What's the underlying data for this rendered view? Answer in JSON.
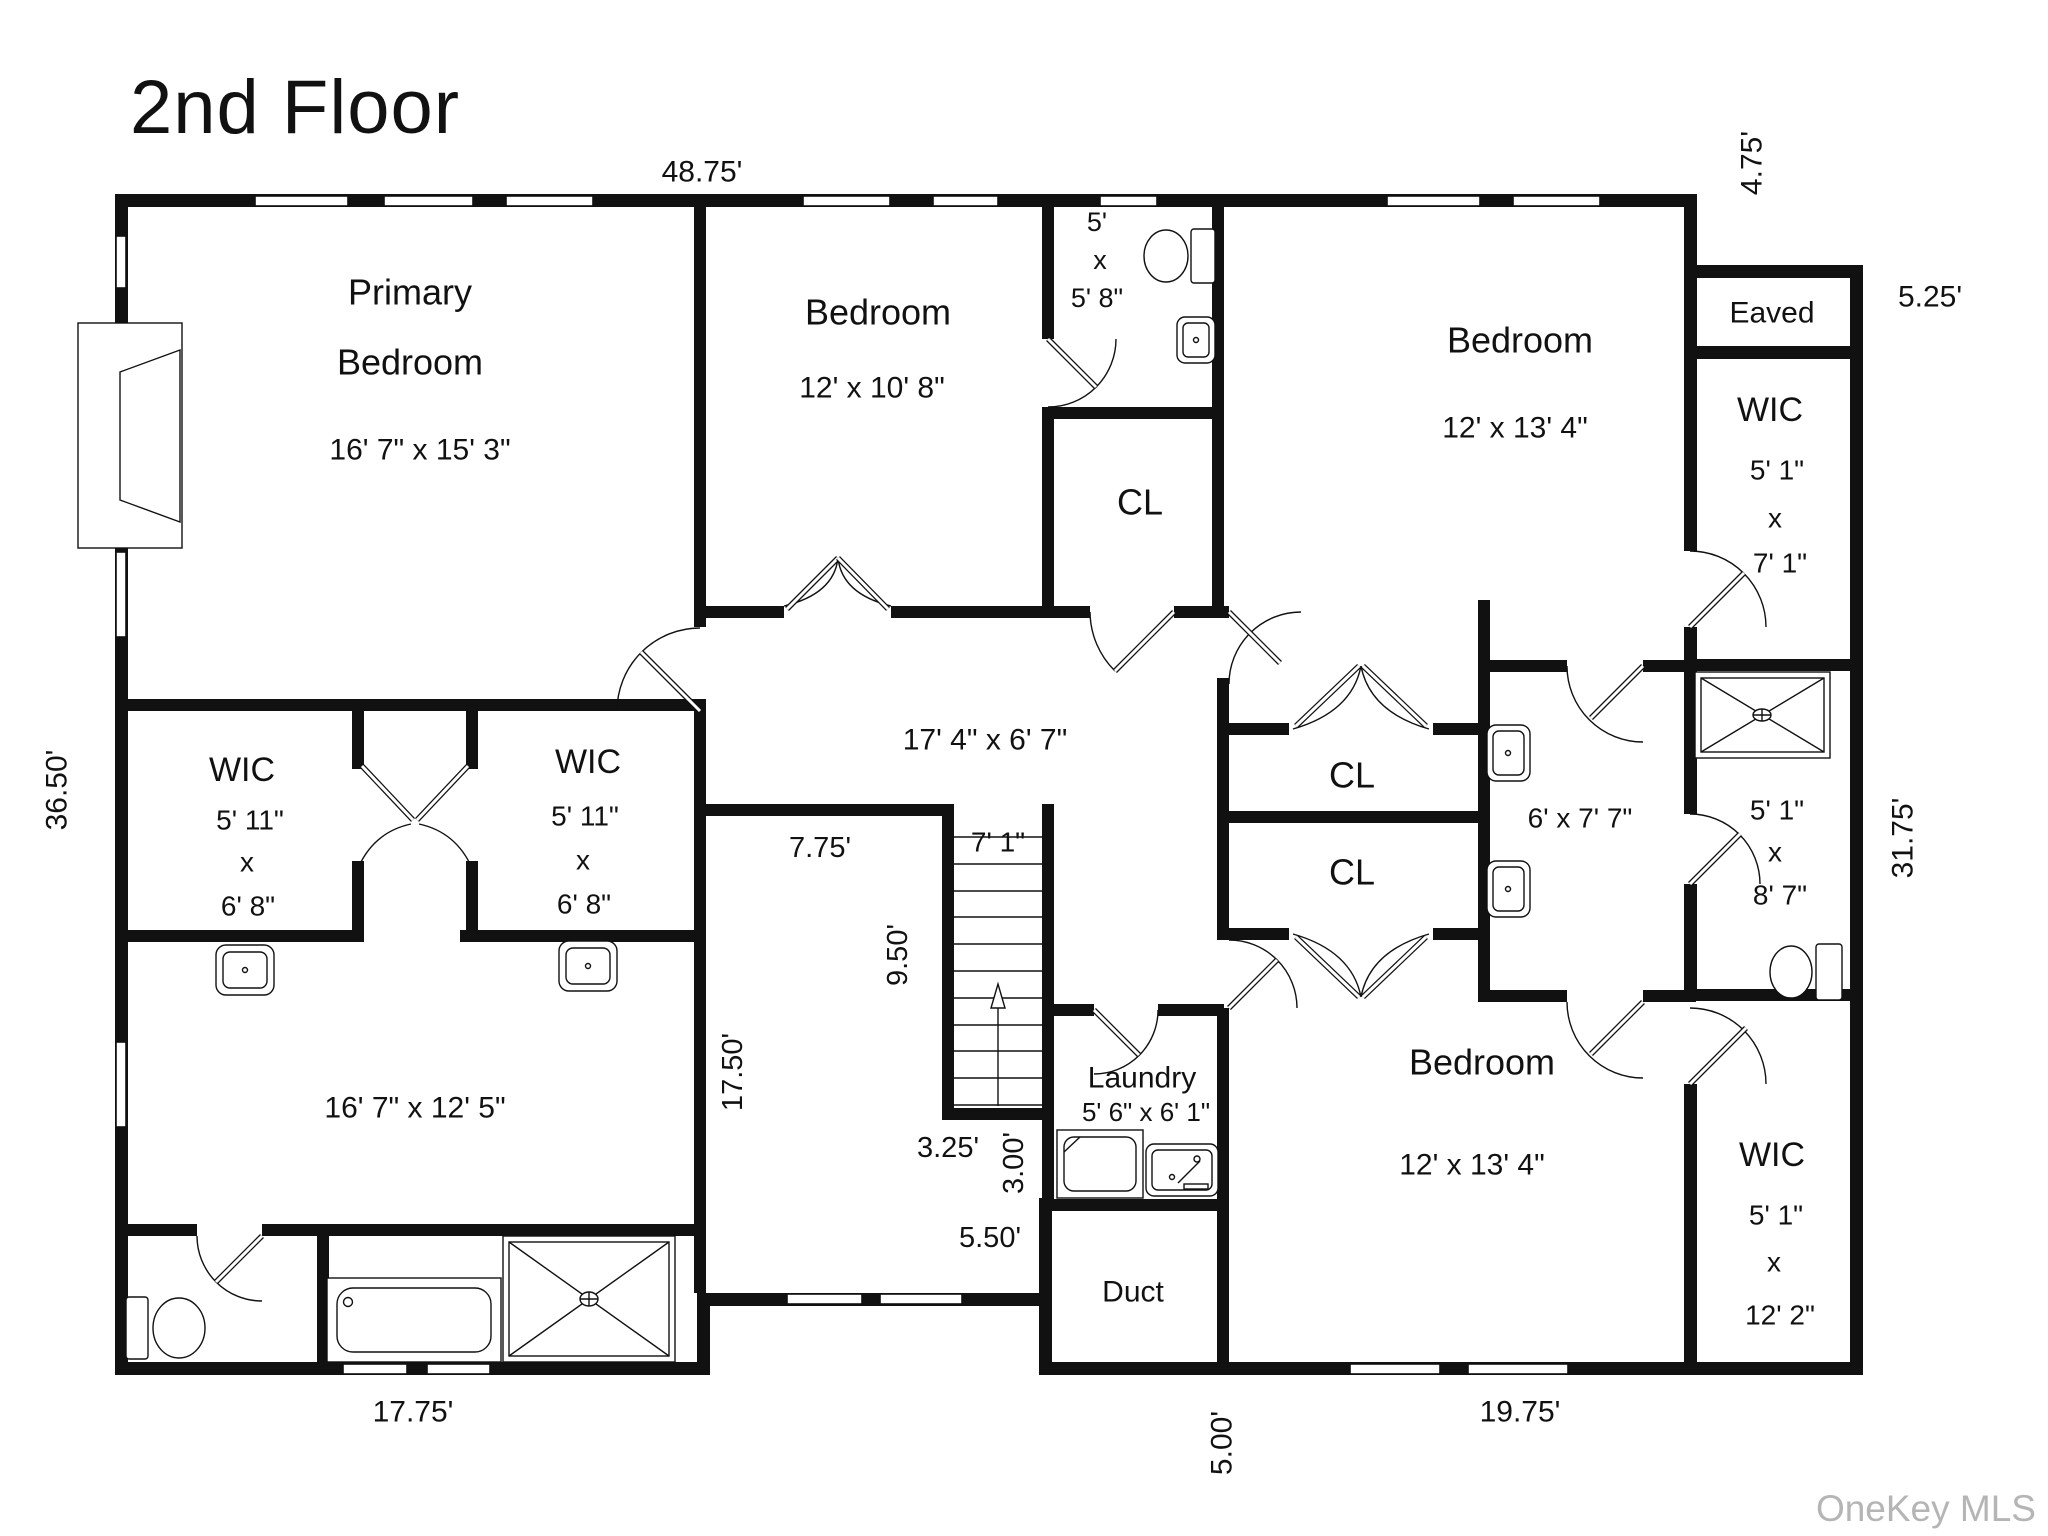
{
  "title": "2nd Floor",
  "watermark": "OneKey MLS",
  "colors": {
    "wall": "#111111",
    "text": "#111111",
    "watermark": "#b5b5b5",
    "background": "#ffffff"
  },
  "labels": [
    {
      "name": "room-primary-bedroom-name-line1",
      "text": "Primary",
      "x": 410,
      "y": 292,
      "size": 36,
      "rotate": false
    },
    {
      "name": "room-primary-bedroom-name-line2",
      "text": "Bedroom",
      "x": 410,
      "y": 362,
      "size": 36,
      "rotate": false
    },
    {
      "name": "room-primary-bedroom-dims",
      "text": "16' 7\" x 15' 3\"",
      "x": 420,
      "y": 450,
      "size": 30,
      "rotate": false
    },
    {
      "name": "room-bedroom-top-middle-name",
      "text": "Bedroom",
      "x": 878,
      "y": 312,
      "size": 36,
      "rotate": false
    },
    {
      "name": "room-bedroom-top-middle-dims",
      "text": "12' x 10' 8\"",
      "x": 872,
      "y": 388,
      "size": 30,
      "rotate": false
    },
    {
      "name": "room-bath-top-dim-1",
      "text": "5'",
      "x": 1097,
      "y": 222,
      "size": 27,
      "rotate": false
    },
    {
      "name": "room-bath-top-dim-2",
      "text": "x",
      "x": 1100,
      "y": 260,
      "size": 27,
      "rotate": false
    },
    {
      "name": "room-bath-top-dim-3",
      "text": "5' 8\"",
      "x": 1097,
      "y": 298,
      "size": 27,
      "rotate": false
    },
    {
      "name": "room-closet-top",
      "text": "CL",
      "x": 1140,
      "y": 502,
      "size": 36,
      "rotate": false
    },
    {
      "name": "hallway-dims",
      "text": "17' 4\" x 6' 7\"",
      "x": 985,
      "y": 740,
      "size": 30,
      "rotate": false
    },
    {
      "name": "room-bedroom-top-right-name",
      "text": "Bedroom",
      "x": 1520,
      "y": 340,
      "size": 36,
      "rotate": false
    },
    {
      "name": "room-bedroom-top-right-dims",
      "text": "12' x 13' 4\"",
      "x": 1515,
      "y": 428,
      "size": 30,
      "rotate": false
    },
    {
      "name": "room-eaved",
      "text": "Eaved",
      "x": 1772,
      "y": 313,
      "size": 30,
      "rotate": false
    },
    {
      "name": "room-wic-top-right-name",
      "text": "WIC",
      "x": 1770,
      "y": 410,
      "size": 34,
      "rotate": false
    },
    {
      "name": "room-wic-top-right-dim-1",
      "text": "5' 1\"",
      "x": 1777,
      "y": 470,
      "size": 28,
      "rotate": false
    },
    {
      "name": "room-wic-top-right-dim-2",
      "text": "x",
      "x": 1775,
      "y": 518,
      "size": 28,
      "rotate": false
    },
    {
      "name": "room-wic-top-right-dim-3",
      "text": "7' 1\"",
      "x": 1780,
      "y": 563,
      "size": 28,
      "rotate": false
    },
    {
      "name": "room-closet-1",
      "text": "CL",
      "x": 1352,
      "y": 775,
      "size": 36,
      "rotate": false
    },
    {
      "name": "room-closet-2",
      "text": "CL",
      "x": 1352,
      "y": 872,
      "size": 36,
      "rotate": false
    },
    {
      "name": "room-bath-right-dims",
      "text": "6' x 7' 7\"",
      "x": 1580,
      "y": 818,
      "size": 28,
      "rotate": false
    },
    {
      "name": "room-wic-mid-right-dim-1",
      "text": "5' 1\"",
      "x": 1777,
      "y": 810,
      "size": 28,
      "rotate": false
    },
    {
      "name": "room-wic-mid-right-dim-2",
      "text": "x",
      "x": 1775,
      "y": 852,
      "size": 28,
      "rotate": false
    },
    {
      "name": "room-wic-mid-right-dim-3",
      "text": "8' 7\"",
      "x": 1780,
      "y": 895,
      "size": 28,
      "rotate": false
    },
    {
      "name": "room-wic-left-name",
      "text": "WIC",
      "x": 242,
      "y": 770,
      "size": 34,
      "rotate": false
    },
    {
      "name": "room-wic-left-dim-1",
      "text": "5' 11\"",
      "x": 250,
      "y": 820,
      "size": 28,
      "rotate": false
    },
    {
      "name": "room-wic-left-dim-2",
      "text": "x",
      "x": 247,
      "y": 862,
      "size": 28,
      "rotate": false
    },
    {
      "name": "room-wic-left-dim-3",
      "text": "6' 8\"",
      "x": 248,
      "y": 906,
      "size": 28,
      "rotate": false
    },
    {
      "name": "room-wic-mid-name",
      "text": "WIC",
      "x": 588,
      "y": 762,
      "size": 34,
      "rotate": false
    },
    {
      "name": "room-wic-mid-dim-1",
      "text": "5' 11\"",
      "x": 585,
      "y": 816,
      "size": 28,
      "rotate": false
    },
    {
      "name": "room-wic-mid-dim-2",
      "text": "x",
      "x": 583,
      "y": 860,
      "size": 28,
      "rotate": false
    },
    {
      "name": "room-wic-mid-dim-3",
      "text": "6' 8\"",
      "x": 584,
      "y": 904,
      "size": 28,
      "rotate": false
    },
    {
      "name": "stair-dim-width",
      "text": "7' 1\"",
      "x": 998,
      "y": 842,
      "size": 28,
      "rotate": false
    },
    {
      "name": "dim-landing-width",
      "text": "7.75'",
      "x": 820,
      "y": 848,
      "size": 29,
      "rotate": false
    },
    {
      "name": "dim-stair-run",
      "text": "9.50'",
      "x": 898,
      "y": 955,
      "size": 29,
      "rotate": true
    },
    {
      "name": "dim-left-section-depth",
      "text": "17.50'",
      "x": 733,
      "y": 1072,
      "size": 29,
      "rotate": true
    },
    {
      "name": "dim-stair-landing-bottom",
      "text": "3.25'",
      "x": 948,
      "y": 1148,
      "size": 29,
      "rotate": false
    },
    {
      "name": "dim-stair-side",
      "text": "3.00'",
      "x": 1014,
      "y": 1163,
      "size": 29,
      "rotate": true
    },
    {
      "name": "dim-recess-width",
      "text": "5.50'",
      "x": 990,
      "y": 1238,
      "size": 29,
      "rotate": false
    },
    {
      "name": "room-laundry-name",
      "text": "Laundry",
      "x": 1142,
      "y": 1078,
      "size": 30,
      "rotate": false
    },
    {
      "name": "room-laundry-dims",
      "text": "5' 6\" x 6' 1\"",
      "x": 1146,
      "y": 1112,
      "size": 26,
      "rotate": false
    },
    {
      "name": "room-duct",
      "text": "Duct",
      "x": 1133,
      "y": 1292,
      "size": 30,
      "rotate": false
    },
    {
      "name": "room-bedroom-bottom-right-name",
      "text": "Bedroom",
      "x": 1482,
      "y": 1062,
      "size": 36,
      "rotate": false
    },
    {
      "name": "room-bedroom-bottom-right-dims",
      "text": "12' x 13' 4\"",
      "x": 1472,
      "y": 1165,
      "size": 30,
      "rotate": false
    },
    {
      "name": "room-wic-bottom-right-name",
      "text": "WIC",
      "x": 1772,
      "y": 1155,
      "size": 34,
      "rotate": false
    },
    {
      "name": "room-wic-bottom-right-dim-1",
      "text": "5' 1\"",
      "x": 1776,
      "y": 1215,
      "size": 28,
      "rotate": false
    },
    {
      "name": "room-wic-bottom-right-dim-2",
      "text": "x",
      "x": 1774,
      "y": 1262,
      "size": 28,
      "rotate": false
    },
    {
      "name": "room-wic-bottom-right-dim-3",
      "text": "12' 2\"",
      "x": 1780,
      "y": 1315,
      "size": 28,
      "rotate": false
    },
    {
      "name": "room-bottom-left-dims",
      "text": "16' 7\" x 12' 5\"",
      "x": 415,
      "y": 1108,
      "size": 30,
      "rotate": false
    },
    {
      "name": "dim-exterior-top",
      "text": "48.75'",
      "x": 702,
      "y": 172,
      "size": 30,
      "rotate": false
    },
    {
      "name": "dim-exterior-notch",
      "text": "4.75'",
      "x": 1752,
      "y": 163,
      "size": 30,
      "rotate": true
    },
    {
      "name": "dim-exterior-eaved",
      "text": "5.25'",
      "x": 1930,
      "y": 297,
      "size": 30,
      "rotate": false
    },
    {
      "name": "dim-exterior-left",
      "text": "36.50'",
      "x": 57,
      "y": 790,
      "size": 30,
      "rotate": true
    },
    {
      "name": "dim-exterior-right",
      "text": "31.75'",
      "x": 1903,
      "y": 838,
      "size": 30,
      "rotate": true
    },
    {
      "name": "dim-exterior-bottom-left",
      "text": "17.75'",
      "x": 413,
      "y": 1412,
      "size": 30,
      "rotate": false
    },
    {
      "name": "dim-exterior-duct",
      "text": "5.00'",
      "x": 1222,
      "y": 1443,
      "size": 30,
      "rotate": true
    },
    {
      "name": "dim-exterior-bottom-right",
      "text": "19.75'",
      "x": 1520,
      "y": 1412,
      "size": 30,
      "rotate": false
    }
  ]
}
